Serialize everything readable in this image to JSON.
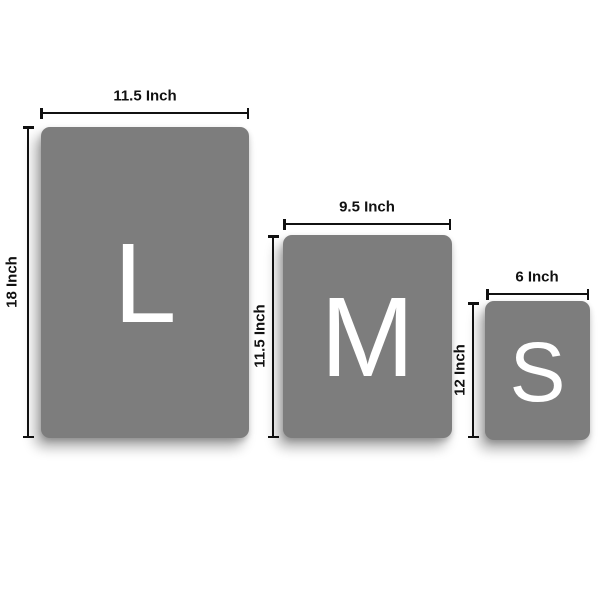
{
  "sizes": [
    {
      "name": "L",
      "letter": "L",
      "width_label": "11.5 Inch",
      "height_label": "18 Inch"
    },
    {
      "name": "M",
      "letter": "M",
      "width_label": "9.5 Inch",
      "height_label": "11.5 Inch"
    },
    {
      "name": "S",
      "letter": "S",
      "width_label": "6 Inch",
      "height_label": "12 Inch"
    }
  ],
  "colors": {
    "background": "#ffffff",
    "panel": "#7d7d7d",
    "letter": "#ffffff",
    "dimension_line": "#111111",
    "label_text": "#111111"
  }
}
